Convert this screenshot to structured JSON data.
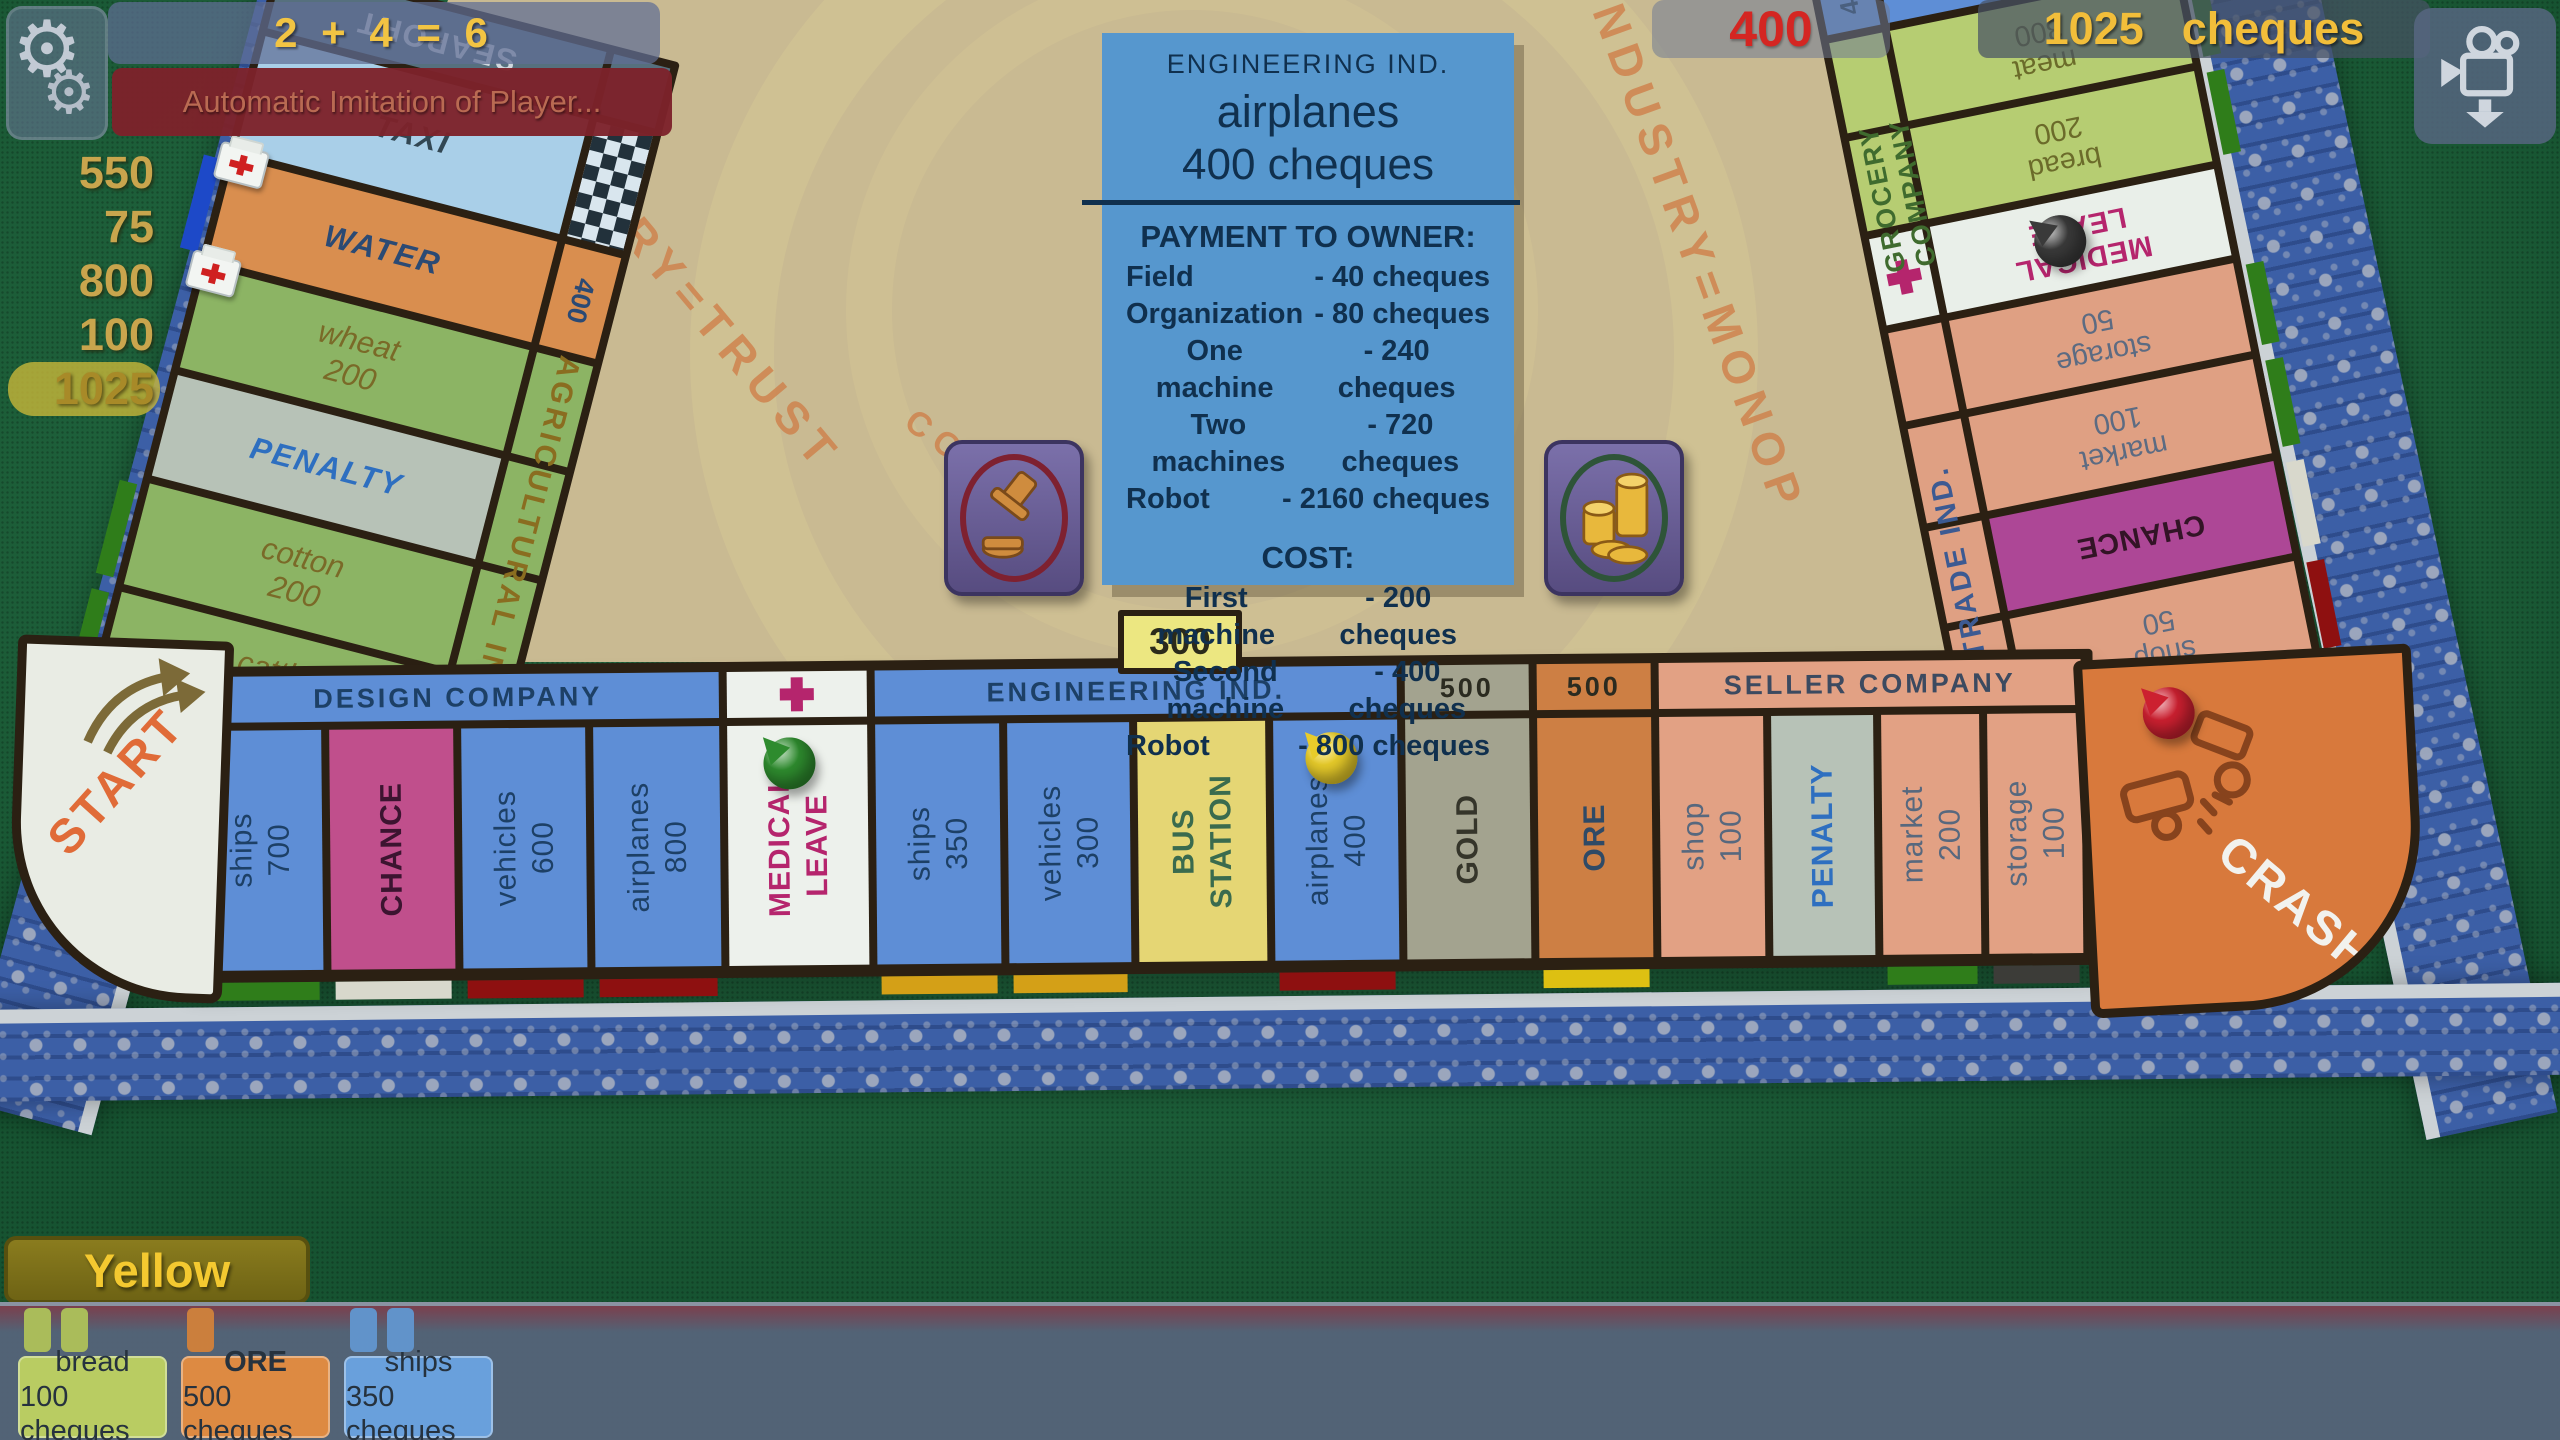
{
  "ui": {
    "dice_result": "2 + 4 = 6",
    "status_message": "Automatic Imitation of Player...",
    "money_list": [
      {
        "value": "550",
        "highlight": false
      },
      {
        "value": "75",
        "highlight": false
      },
      {
        "value": "800",
        "highlight": false
      },
      {
        "value": "100",
        "highlight": false
      },
      {
        "value": "1025",
        "highlight": true
      }
    ],
    "rent_amount": "400",
    "balance_amount": "1025",
    "balance_unit": "cheques",
    "player_name": "Yellow",
    "owned_cards": [
      {
        "name": "bread",
        "price": "100 cheques",
        "color": "#b9cc62",
        "tabs": 2,
        "bold": false
      },
      {
        "name": "ORE",
        "price": "500 cheques",
        "color": "#dd8a42",
        "tabs": 1,
        "bold": true
      },
      {
        "name": "ships",
        "price": "350 cheques",
        "color": "#69a0dc",
        "tabs": 2,
        "bold": false
      }
    ]
  },
  "property_card": {
    "group": "ENGINEERING IND.",
    "name": "airplanes",
    "price": "400 cheques",
    "payment_title": "PAYMENT TO OWNER:",
    "payments": [
      [
        "Field",
        "-   40 cheques"
      ],
      [
        "Organization",
        "-  80 cheques"
      ],
      [
        "One machine",
        "-  240 cheques"
      ],
      [
        "Two machines",
        "-  720 cheques"
      ],
      [
        "Robot",
        "-  2160 cheques"
      ]
    ],
    "cost_title": "COST:",
    "costs": [
      [
        "First machine",
        "-  200 cheques"
      ],
      [
        "Second machine",
        "-  400 cheques"
      ],
      [
        "Robot",
        "-  800 cheques"
      ]
    ]
  },
  "price_tag": "300",
  "board": {
    "center": {
      "arc_left": "INDUSTRY=TRUST",
      "arc_right": "INDUSTRY=MONOP",
      "arc_small": "CO"
    },
    "corners": {
      "start": "START",
      "crash": "CRASH"
    },
    "group_labels": {
      "agricultural": "AGRICULTURAL  IND.",
      "trade": "TRADE  IND.",
      "grocery": "GROCERY  COMPANY"
    },
    "bottom_row": [
      {
        "header": "DESIGN  COMPANY",
        "header_bg": "#5e8ed6",
        "header_color": "#1d4066",
        "tiles": [
          {
            "lines": [
              "ships",
              "700"
            ],
            "bg": "#5e8ed6",
            "color": "#1d4066",
            "w": 124,
            "strip": "#2f7d1a"
          },
          {
            "lines": [
              "CHANCE"
            ],
            "bg": "#c04f8c",
            "color": "#3c1430",
            "w": 124,
            "bold": true,
            "strip": "#d8d8cc"
          },
          {
            "lines": [
              "vehicles",
              "600"
            ],
            "bg": "#5e8ed6",
            "color": "#1d4066",
            "w": 124,
            "strip": "#8e1010"
          },
          {
            "lines": [
              "airplanes",
              "800"
            ],
            "bg": "#5e8ed6",
            "color": "#1d4066",
            "w": 126,
            "strip": "#8e1010"
          }
        ]
      },
      {
        "header": "",
        "cross": true,
        "header_bg": "#edf1ec",
        "header_color": "#b5256d",
        "tiles": [
          {
            "lines": [
              "MEDICAL",
              "LEAVE"
            ],
            "bg": "#edf1ec",
            "color": "#b5256d",
            "w": 140,
            "bold": true,
            "piece": "#2e8b2e"
          }
        ]
      },
      {
        "header": "ENGINEERING  IND.",
        "header_bg": "#5e8ed6",
        "header_color": "#1d4066",
        "tiles": [
          {
            "lines": [
              "ships",
              "350"
            ],
            "bg": "#5e8ed6",
            "color": "#1d4066",
            "w": 124,
            "strip": "#d4a017"
          },
          {
            "lines": [
              "vehicles",
              "300"
            ],
            "bg": "#5e8ed6",
            "color": "#1d4066",
            "w": 122,
            "strip": "#d4a017"
          },
          {
            "lines": [
              "BUS",
              "STATION"
            ],
            "bg": "#e5d674",
            "color": "#3a6b4e",
            "w": 128,
            "bold": true
          },
          {
            "lines": [
              "airplanes",
              "400"
            ],
            "bg": "#5e8ed6",
            "color": "#1d4066",
            "w": 124,
            "strip": "#8e1010",
            "piece": "#e8cc2a"
          }
        ]
      },
      {
        "header": "500",
        "header_bg": "#a3a38f",
        "header_color": "#2b2b20",
        "tiles": [
          {
            "lines": [
              "GOLD"
            ],
            "bg": "#a3a38f",
            "color": "#35352a",
            "w": 124,
            "bold": true
          }
        ]
      },
      {
        "header": "500",
        "header_bg": "#cd7f44",
        "header_color": "#2b2b20",
        "tiles": [
          {
            "lines": [
              "ORE"
            ],
            "bg": "#cd7f44",
            "color": "#2f4a66",
            "w": 114,
            "bold": true,
            "strip": "#ddc012"
          }
        ]
      },
      {
        "header": "SELLER  COMPANY",
        "header_bg": "#e2a184",
        "header_color": "#3c4a60",
        "tiles": [
          {
            "lines": [
              "shop",
              "100"
            ],
            "bg": "#e2a184",
            "color": "#57687e",
            "w": 104
          },
          {
            "lines": [
              "PENALTY"
            ],
            "bg": "#b7c2b7",
            "color": "#2e6fc0",
            "w": 102,
            "bold": true
          },
          {
            "lines": [
              "market",
              "200"
            ],
            "bg": "#e2a184",
            "color": "#57687e",
            "w": 98,
            "strip": "#2f7d1a"
          },
          {
            "lines": [
              "storage",
              "100"
            ],
            "bg": "#e2a184",
            "color": "#57687e",
            "w": 94,
            "strip": "#3c3c38"
          }
        ]
      }
    ],
    "left_column": [
      {
        "lines": [
          "SEAPORT"
        ],
        "bg": "#56707e",
        "color": "#cfd8de",
        "h": 62,
        "bold": true,
        "flip": true,
        "band": {
          "kind": "color",
          "bg": "#56707e"
        }
      },
      {
        "lines": [
          "TAXI"
        ],
        "bg": "#a9cfe8",
        "color": "#324753",
        "h": 118,
        "bold": true,
        "italic": true,
        "band": {
          "kind": "checker"
        }
      },
      {
        "lines": [
          "WATER"
        ],
        "bg": "#d98e4f",
        "color": "#2b4a74",
        "h": 104,
        "bold": true,
        "italic": true,
        "band": {
          "kind": "text",
          "bg": "#d98e4f",
          "text": "400"
        },
        "strip": "#1d49c8",
        "medkit": true
      },
      {
        "lines": [
          "wheat",
          "200"
        ],
        "bg": "#8cb464",
        "color": "#7a6a28",
        "h": 104,
        "italic": true,
        "band": {
          "kind": "color",
          "bg": "#8cb464"
        },
        "medkit": true
      },
      {
        "lines": [
          "PENALTY"
        ],
        "bg": "#b7c2b7",
        "color": "#2e6fc0",
        "h": 104,
        "bold": true,
        "italic": true,
        "band": {
          "kind": "color",
          "bg": "#8cb464"
        }
      },
      {
        "lines": [
          "cotton",
          "200"
        ],
        "bg": "#8cb464",
        "color": "#7a6a28",
        "h": 104,
        "italic": true,
        "band": {
          "kind": "color",
          "bg": "#8cb464"
        },
        "strip": "#2f7d1a"
      },
      {
        "lines": [
          "cattle",
          "250"
        ],
        "bg": "#8cb464",
        "color": "#7a6a28",
        "h": 112,
        "italic": true,
        "band": {
          "kind": "color",
          "bg": "#8cb464"
        },
        "strip": "#2f7d1a"
      }
    ],
    "right_column": [
      {
        "lines": [
          "AIRPORT"
        ],
        "bg": "#5e8ed6",
        "color": "#1d4066",
        "h": 74,
        "bold": true,
        "band": {
          "kind": "text",
          "bg": "#5e8ed6",
          "text": "400"
        }
      },
      {
        "lines": [
          "meat",
          "300"
        ],
        "bg": "#b6cd72",
        "color": "#6b6b2a",
        "h": 92,
        "band": {
          "kind": "color",
          "bg": "#b6cd72"
        },
        "strip": "#2f7d1a"
      },
      {
        "lines": [
          "bread",
          "200"
        ],
        "bg": "#b6cd72",
        "color": "#6b6b2a",
        "h": 92,
        "band": {
          "kind": "color",
          "bg": "#b6cd72"
        },
        "strip": "#2f7d1a"
      },
      {
        "lines": [
          "MEDICAL",
          "LEAVE"
        ],
        "bg": "#e9efe9",
        "color": "#b5256d",
        "h": 88,
        "bold": true,
        "band": {
          "kind": "cross",
          "bg": "#e9efe9"
        },
        "piece": "#3a3a3a"
      },
      {
        "lines": [
          "storage",
          "50"
        ],
        "bg": "#dfa083",
        "color": "#5c6b82",
        "h": 90,
        "band": {
          "kind": "color",
          "bg": "#dfa083"
        },
        "strip": "#2f7d1a"
      },
      {
        "lines": [
          "market",
          "100"
        ],
        "bg": "#dfa083",
        "color": "#5c6b82",
        "h": 96,
        "band": {
          "kind": "color",
          "bg": "#dfa083"
        },
        "strip": "#2f7d1a"
      },
      {
        "lines": [
          "CHANCE"
        ],
        "bg": "#ad4796",
        "color": "#331426",
        "h": 94,
        "bold": true,
        "band": {
          "kind": "color",
          "bg": "#dfa083"
        },
        "strip": "#d8d8cc"
      },
      {
        "lines": [
          "shop",
          "50"
        ],
        "bg": "#dfa083",
        "color": "#5c6b82",
        "h": 96,
        "band": {
          "kind": "color",
          "bg": "#dfa083"
        },
        "strip": "#8e1010"
      }
    ]
  }
}
